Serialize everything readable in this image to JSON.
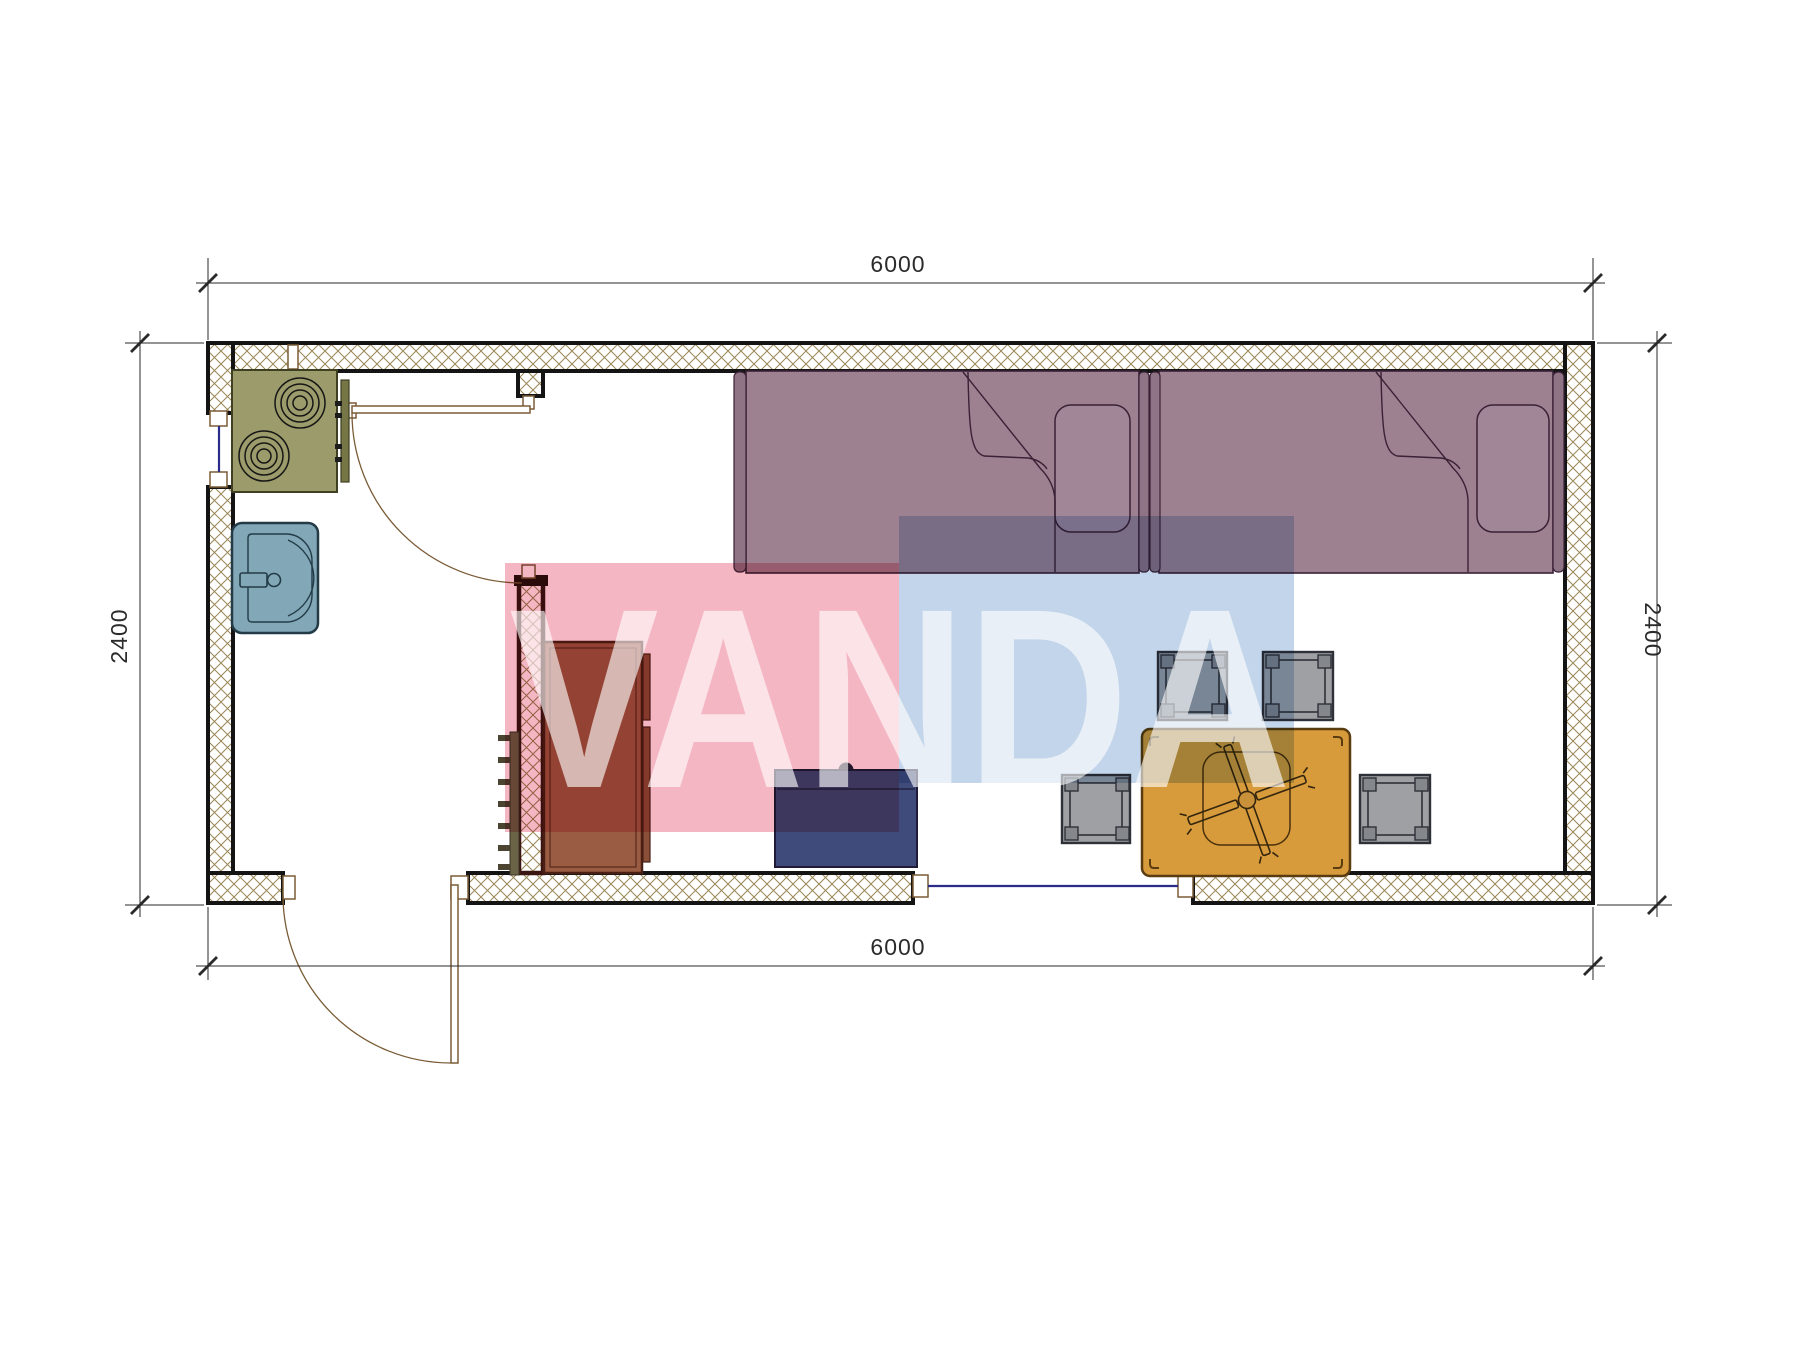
{
  "drawing": {
    "kind": "floor-plan",
    "elements": [
      "exterior-walls",
      "entrance-door",
      "interior-door",
      "window-left",
      "window-bottom",
      "stove",
      "sink",
      "wardrobe",
      "ladder",
      "partition-wall",
      "bed-left",
      "bed-right",
      "nightstand",
      "dining-table",
      "ceiling-fan-symbol",
      "stool",
      "dimension-lines"
    ]
  },
  "dimensions": {
    "top": "6000",
    "bottom": "6000",
    "left": "2400",
    "right": "2400"
  },
  "watermark": {
    "text": "VANDA",
    "pink": "#F5B6C3",
    "blue": "#C3D5EA"
  },
  "colors": {
    "wall_hatch": "#9A8756",
    "wall_line": "#141414",
    "bed": "#9E8191",
    "bed_trim": "#8F7485",
    "pillow": "#A18697",
    "stove": "#9B9B6B",
    "stove_panel": "#767646",
    "sink": "#82A7B7",
    "cabinet": "#9A5C42",
    "cabinet_door": "#8A4F38",
    "nightstand": "#3F4B7A",
    "table": "#D89B3C",
    "stool": "#9EA0A4",
    "stool_pad": "#84878C",
    "ladder": "#6B6345",
    "window_glass": "#2B2B8A",
    "door_line": "#7A5C36"
  }
}
